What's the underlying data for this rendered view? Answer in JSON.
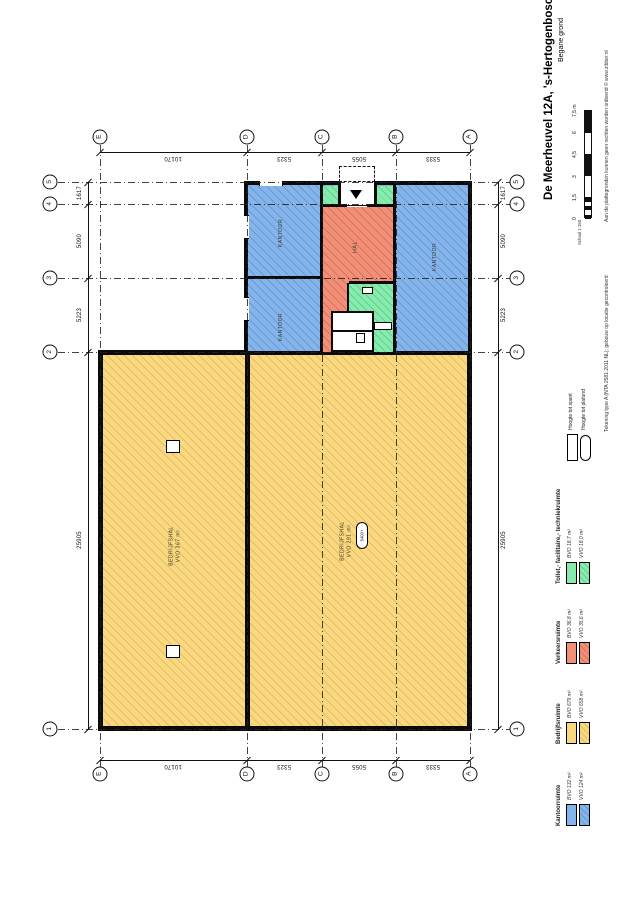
{
  "title_block": {
    "title": "De Meerheuvel 12A, 's-Hertogenbosch",
    "subtitle": "Begane grond",
    "scale_label": "Schaal 1:150",
    "scale_ticks": [
      "0",
      "1,5",
      "3",
      "4,5",
      "6",
      "7,5 m"
    ],
    "disclaimer": "Aan de plattegronden kunnen geen rechten worden ontleend © www.zibber.nl",
    "drawing_type_note": "Tekening type A (NTA 2581:2011 NL); gebouw op locatie gecontroleerd"
  },
  "legend": {
    "entries": [
      {
        "label": "Toilet,- facilitaire,- techniekruimte",
        "bvo": "BVO 18,7 m²",
        "vvo": "VVO 18,0 m²"
      },
      {
        "label": "Verkeersruimte",
        "bvo": "BVO 36,8 m²",
        "vvo": "VVO 35,6 m²"
      },
      {
        "label": "Bedrijfsruimte",
        "bvo": "BVO 679 m²",
        "vvo": "VVO 658 m²"
      },
      {
        "label": "Kantoorruimte",
        "bvo": "BVO 132 m²",
        "vvo": "VVO 124 m²"
      }
    ],
    "heights": [
      {
        "label": "Hoogte tot spant"
      },
      {
        "label": "Hoogte tot plafond"
      }
    ]
  },
  "plan": {
    "rooms": {
      "kantoor": "KANTOOR",
      "hal": "HAL",
      "bedrijfshal": "BEDRIJFSHAL",
      "bedrijfshal_left_area": "VVO 367 m²",
      "bedrijfshal_right_area": "VVO 291 m²",
      "height_tag": "5400+"
    },
    "grid": {
      "letters": [
        "E",
        "D",
        "C",
        "B",
        "A"
      ],
      "numbers": [
        "5",
        "4",
        "3",
        "2",
        "1"
      ]
    },
    "dimensions": {
      "horizontal": [
        "10170",
        "5323",
        "5055",
        "5333"
      ],
      "vertical": [
        "1617",
        "5090",
        "5223",
        "25905"
      ]
    }
  },
  "colors": {
    "yellow": "#FAD87F",
    "yellowh": "#D9B55C",
    "blue": "#84B4EA",
    "blueh": "#5C8FD0",
    "red": "#F28F78",
    "redh": "#D2664E",
    "green": "#87EBAD",
    "greenh": "#54C584"
  }
}
